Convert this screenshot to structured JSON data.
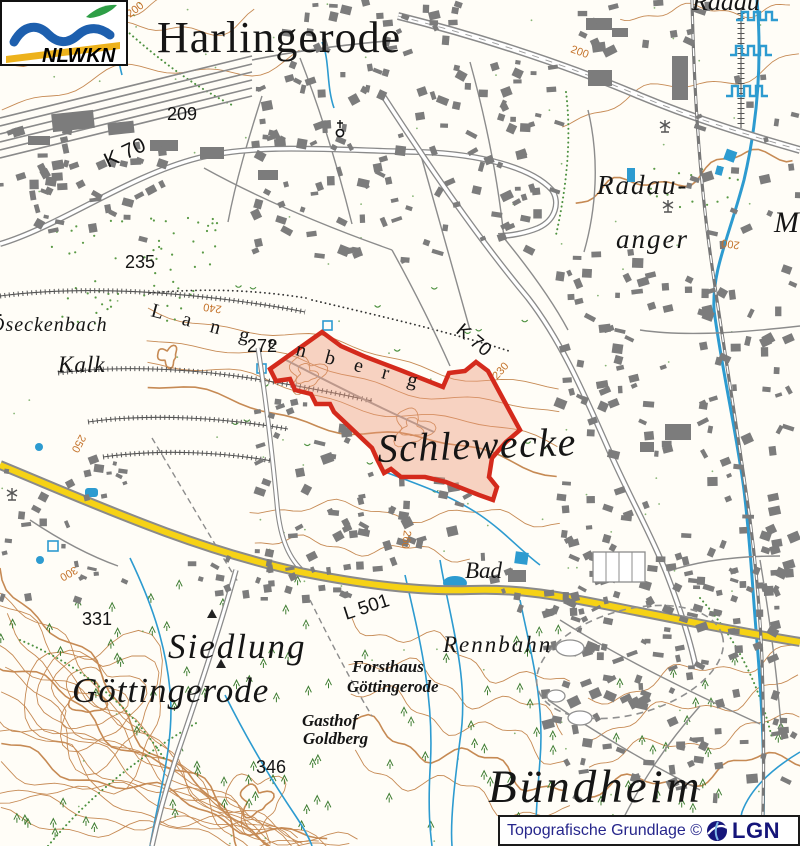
{
  "map": {
    "place_labels": {
      "harlingerode": "Harlingerode",
      "radau_anger_line1": "Radau-",
      "radau_anger_line2": "anger",
      "langenberg": "Langenberg",
      "oeseckenbach": "Öseckenbach",
      "kalk": "Kalk",
      "schlewecke": "Schlewecke",
      "bad": "Bad",
      "siedlung_line1": "Siedlung",
      "siedlung_line2": "Göttingerode",
      "forsthaus_line1": "Forsthaus",
      "forsthaus_line2": "Göttingerode",
      "gasthof_line1": "Gasthof",
      "gasthof_line2": "Goldberg",
      "rennbahn": "Rennbahn",
      "buendheim": "Bündheim",
      "partial_m": "M",
      "partial_radau": "Radau"
    },
    "road_labels": {
      "k70_west": "K 70",
      "k70_east": "K 70",
      "l501": "L 501"
    },
    "spot_heights": {
      "p209": "209",
      "p235": "235",
      "p272": "272",
      "p331": "331",
      "p346": "346"
    },
    "contour_labels": {
      "c200_nw": "200",
      "c200_ne": "200",
      "c200_e": "200",
      "c230": "230",
      "c240": "240",
      "c250": "250",
      "c260": "260",
      "c300": "300"
    }
  },
  "logo": {
    "org": "NLWKN"
  },
  "attribution": {
    "text": "Topografische Grundlage ©",
    "agency": "LGN"
  },
  "colors": {
    "highlight_stroke": "#d42a1c",
    "highlight_fill": "#eb9678",
    "road_yellow": "#f6d215",
    "water": "#2d9bd0",
    "contour": "#c68a54"
  }
}
